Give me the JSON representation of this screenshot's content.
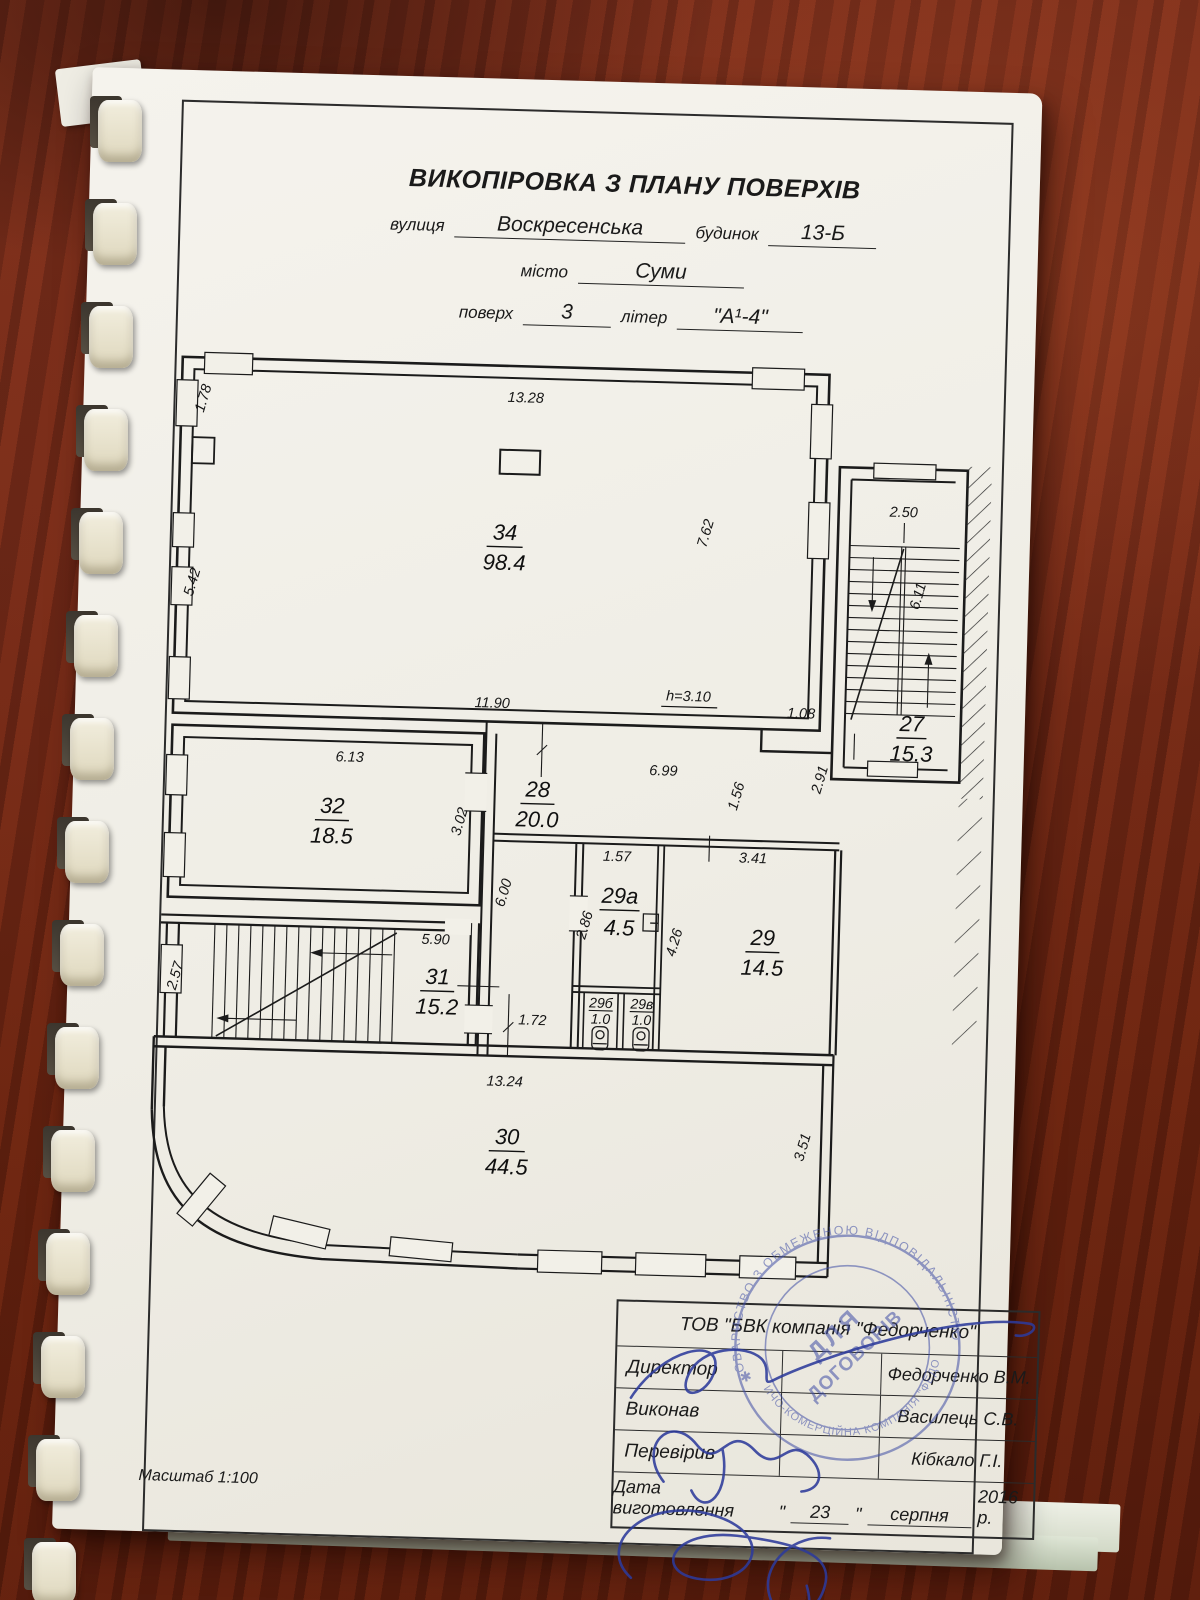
{
  "document": {
    "title": "ВИКОПІРОВКА З ПЛАНУ ПОВЕРХІВ",
    "fields": {
      "street_label": "вулиця",
      "street_value": "Воскресенська",
      "building_label": "будинок",
      "building_value": "13-Б",
      "city_label": "місто",
      "city_value": "Суми",
      "floor_label": "поверх",
      "floor_value": "3",
      "letter_label": "літер",
      "letter_value": "\"А¹-4\""
    },
    "scale_note": "Масштаб 1:100"
  },
  "plan": {
    "height_note": "h=3.10",
    "rooms": {
      "r34": {
        "number": "34",
        "area": "98.4"
      },
      "r27": {
        "number": "27",
        "area": "15.3"
      },
      "r32": {
        "number": "32",
        "area": "18.5"
      },
      "r28": {
        "number": "28",
        "area": "20.0"
      },
      "r29a": {
        "number": "29а",
        "area": "4.5"
      },
      "r29": {
        "number": "29",
        "area": "14.5"
      },
      "r29b": {
        "number": "29б",
        "area": "1.0"
      },
      "r29v": {
        "number": "29в",
        "area": "1.0"
      },
      "r31": {
        "number": "31",
        "area": "15.2"
      },
      "r30": {
        "number": "30",
        "area": "44.5"
      }
    },
    "dims": {
      "w178": "1.78",
      "w1328": "13.28",
      "w542": "5.42",
      "w762": "7.62",
      "w1190": "11.90",
      "w108": "1.08",
      "w250": "2.50",
      "w611": "6.11",
      "w291": "2.91",
      "w613": "6.13",
      "w302": "3.02",
      "w699": "6.99",
      "w156": "1.56",
      "w600": "6.00",
      "w157": "1.57",
      "w286": "2.86",
      "w341": "3.41",
      "w426": "4.26",
      "w590": "5.90",
      "w257": "2.57",
      "w172": "1.72",
      "w1324": "13.24",
      "w351": "3.51"
    }
  },
  "titleblock": {
    "company": "ТОВ \"БВК компанія \"Федорченко\"",
    "rows": [
      {
        "label": "Директор",
        "value": "Федорченко  В.М."
      },
      {
        "label": "Виконав",
        "value": "Василець С.В."
      },
      {
        "label": "Перевірив",
        "value": "Кібкало Г.І."
      }
    ],
    "date": {
      "label": "Дата виготовлення",
      "open_quote": "\"",
      "day": "23",
      "close_quote": "\"",
      "month": "серпня",
      "year": "2016 р."
    }
  },
  "stamp": {
    "arc_top": "ТОВАРИСТВО З ОБМЕЖЕНОЮ ВІДПОВІДАЛЬНІСТЮ",
    "arc_bottom": "ВИРОБНИЧО-КОМЕРЦІЙНА КОМПАНІЯ \"ФЕДОРЧЕНКО\"",
    "center_line1": "ДЛЯ",
    "center_line2": "ДОГОВОРІВ",
    "separator": "✱",
    "ink_color": "#3f4da5"
  }
}
